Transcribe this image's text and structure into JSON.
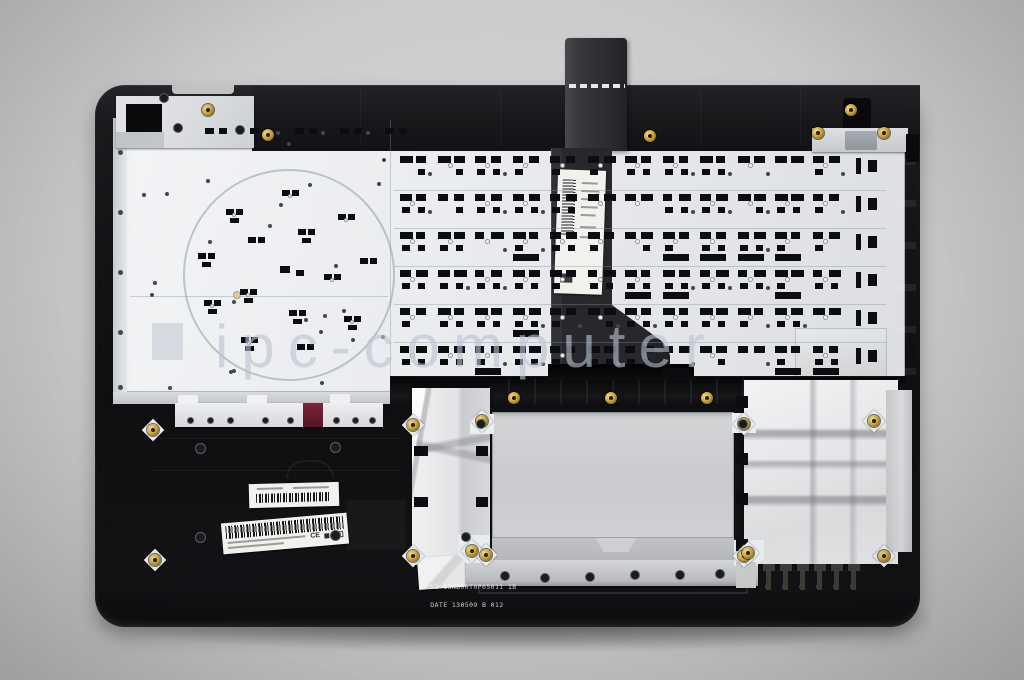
{
  "photo": {
    "subject": "laptop-palmrest-keyboard-assembly-rear-view"
  },
  "watermark": {
    "text": "ipc-computer",
    "color": "rgba(186,196,208,0.62)"
  },
  "part_stamp": {
    "line1": "S2 13NB00T0P05011 1B",
    "line2": "DATE 130509 B 012"
  },
  "large_sticker": {
    "ce_mark": "CE"
  },
  "colors": {
    "background": "#cbcbcc",
    "shell_black": "#121214",
    "metal_plate": "#e9ebee",
    "touchpad_plate": "#cfd0d2",
    "foil": "#e4e5e7",
    "gold_screw": "#cda63c",
    "magenta_chip": "#6c2033",
    "cable": "#2b2b2e"
  }
}
